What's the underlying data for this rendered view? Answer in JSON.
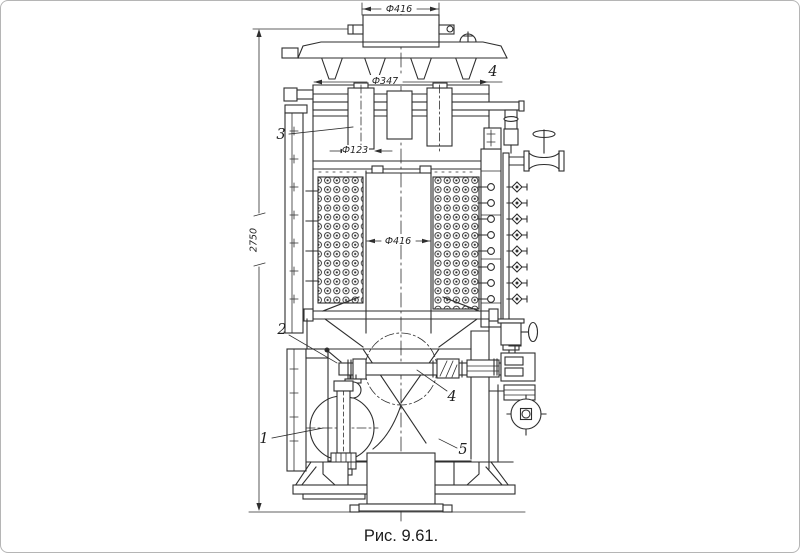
{
  "figure": {
    "caption": "Рис. 9.61.",
    "dimensions": {
      "top_diameter": "Ф416",
      "flange_diameter": "Ф347",
      "nozzle_diameter": "Ф123",
      "shell_inner_diameter": "Ф416",
      "overall_height": "2750"
    },
    "callouts": {
      "part1": "1",
      "part2": "2",
      "part3": "3",
      "part4_upper": "4",
      "part4_lower": "4",
      "part5": "5"
    },
    "style": {
      "ink": "#2e2e2e",
      "background": "#ffffff",
      "frame_border": "#b5b5b5"
    }
  }
}
